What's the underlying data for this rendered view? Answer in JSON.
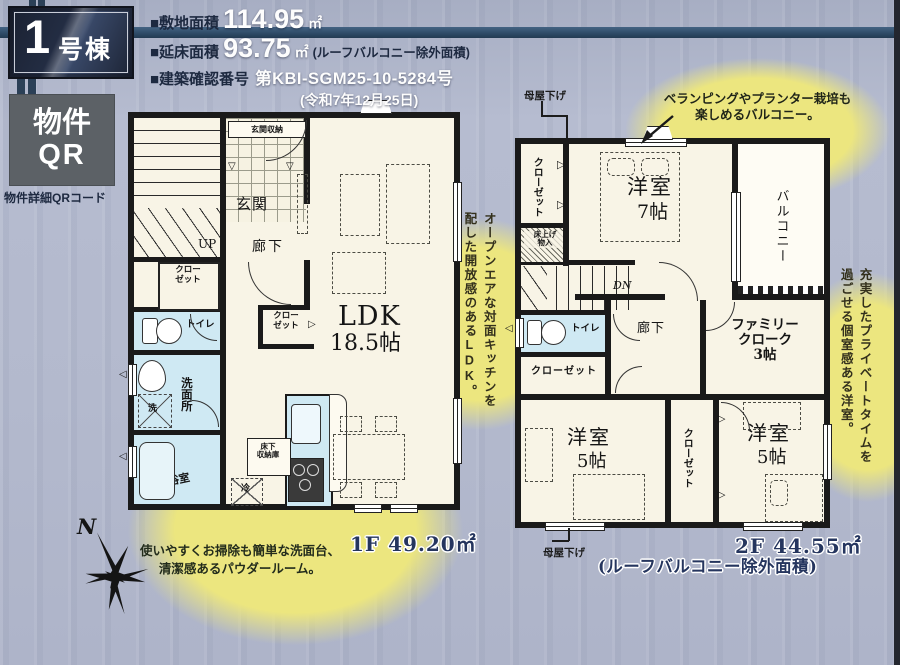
{
  "header": {
    "badge_number": "1",
    "badge_suffix": "号棟",
    "line1_label": "■敷地面積",
    "line1_value": "114.95",
    "line1_unit": "㎡",
    "line2_label": "■延床面積",
    "line2_value": "93.75",
    "line2_unit": "㎡",
    "line2_note": "(ルーフバルコニー除外面積)",
    "line3_label": "■建築確認番号",
    "line3_value": "第KBI-SGM25-10-5284号",
    "line4_date": "(令和7年12月25日)"
  },
  "qr": {
    "label_line1": "物件",
    "label_line2": "QR",
    "caption": "物件詳細QRコード"
  },
  "compass": {
    "north": "N"
  },
  "floor1": {
    "genkan_storage": "玄関収納",
    "genkan": "玄関",
    "up": "UP",
    "hallway": "廊下",
    "closet_a_l1": "クロー",
    "closet_a_l2": "ゼット",
    "closet_b_l1": "クロー",
    "closet_b_l2": "ゼット",
    "toilet": "トイレ",
    "washroom": "洗面所",
    "washer": "洗",
    "bathroom": "浴室",
    "ldk": "LDK",
    "ldk_size": "18.5帖",
    "underfloor_l1": "床下",
    "underfloor_l2": "収納庫",
    "fridge": "冷",
    "area_label": "1F 49.20㎡",
    "caption_l1": "使いやすくお掃除も簡単な洗面台、",
    "caption_l2": "清潔感あるパウダールーム。"
  },
  "floor2": {
    "moya_top": "母屋下げ",
    "moya_bottom": "母屋下げ",
    "closet_tl": "クローゼット",
    "storage_l1": "床上げ",
    "storage_l2": "物入",
    "bedroom7": "洋室",
    "bedroom7_size": "7帖",
    "balcony": "バルコニー",
    "dn": "DN",
    "toilet": "トイレ",
    "hallway": "廊下",
    "fc_l1": "ファミリー",
    "fc_l2": "クローク",
    "fc_l3": "3帖",
    "closet_mid": "クローゼット",
    "bedroom5l": "洋室",
    "bedroom5l_size": "5帖",
    "closet_bottom": "クローゼット",
    "bedroom5r": "洋室",
    "bedroom5r_size": "5帖",
    "area_label": "2F 44.55㎡",
    "area_note": "(ルーフバルコニー除外面積)"
  },
  "annotations": {
    "balcony_l1": "ベランピングやプランター栽培も",
    "balcony_l2": "楽しめるバルコニー。",
    "ldk_col1": "オープンエアな対面キッチンを",
    "ldk_col2": "配した開放感のあるLDK。",
    "room_col1": "充実したプライベートタイムを",
    "room_col2": "過ごせる個室感ある洋室。"
  },
  "colors": {
    "wall": "#1a1a1a",
    "wet_room": "#cfe9f3",
    "floor": "#f8f4e6",
    "highlight_circle": "#ece67f",
    "navy_text": "#1d2940",
    "header_band": "#35536f"
  }
}
